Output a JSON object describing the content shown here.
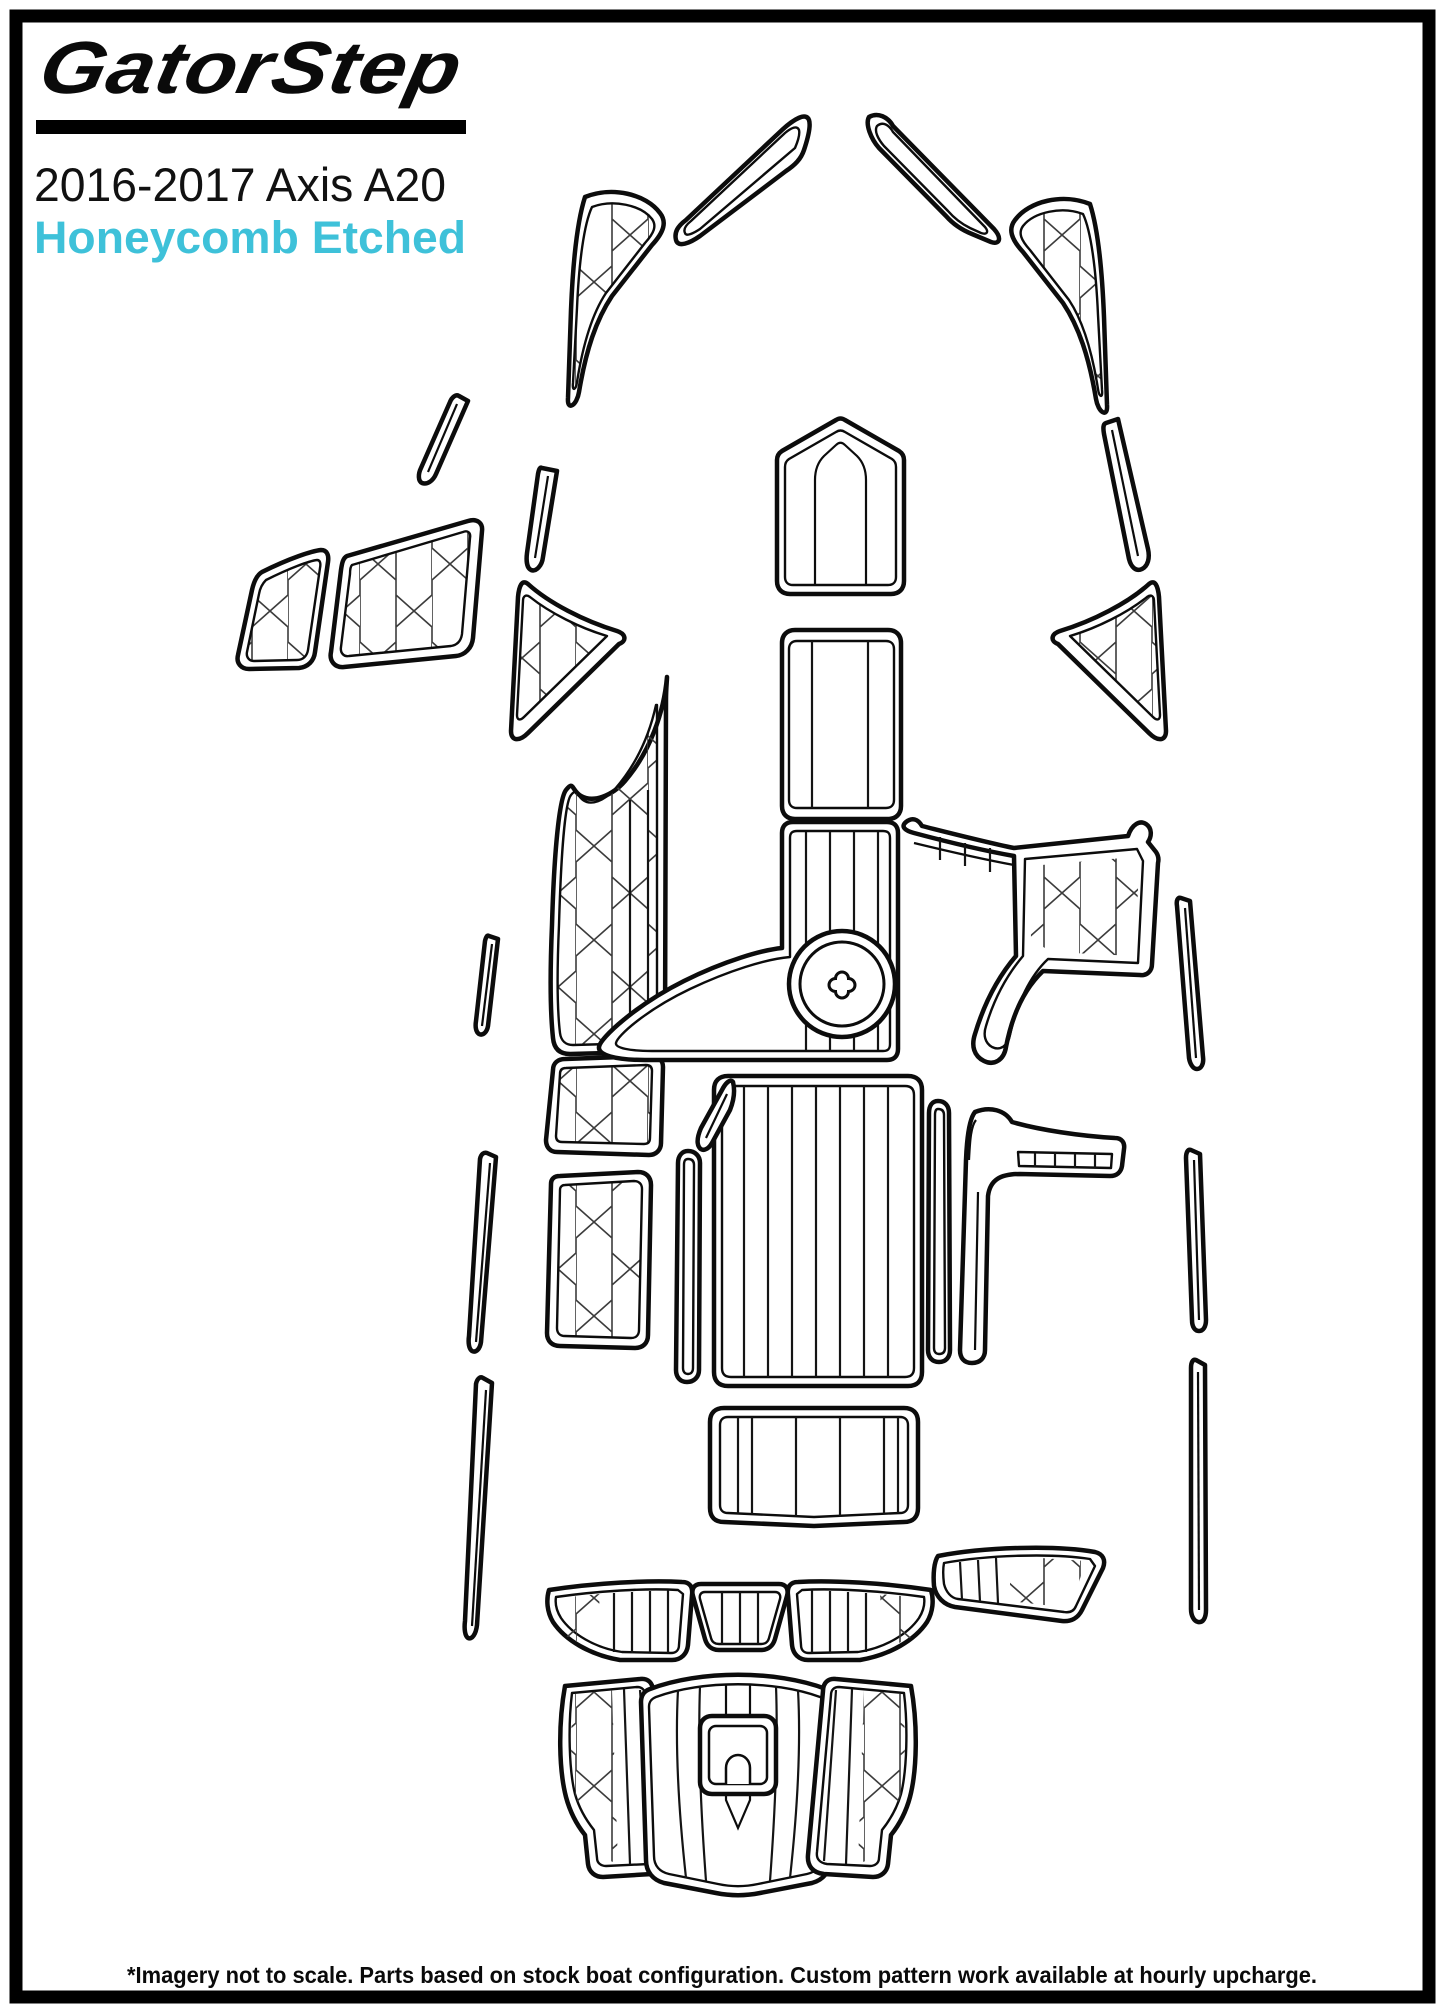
{
  "header": {
    "brand": "GatorStep",
    "title": "2016-2017 Axis A20",
    "subtitle": "Honeycomb Etched",
    "subtitle_color": "#3EC1D9",
    "brand_color": "#0a0a0a"
  },
  "footer": {
    "note": "*Imagery not to scale. Parts based on stock boat configuration. Custom pattern work available at hourly upcharge."
  },
  "page": {
    "background": "#ffffff",
    "border_color": "#000000",
    "line_color": "#0c0c0c"
  },
  "diagram": {
    "kind": "boat-deck-pad-template-top-view",
    "texture": "honeycomb-etched",
    "pieces": [
      "port-bow-pad",
      "port-bow-gunwale-strip",
      "starboard-bow-gunwale-strip",
      "starboard-bow-pad",
      "port-hull-strip-upper",
      "port-hull-strip-lower",
      "starboard-hull-strip",
      "port-storage-pad-small",
      "port-storage-pad-large",
      "port-step-triangle-pad",
      "starboard-step-triangle-pad",
      "port-bow-step-pad",
      "port-mid-pad-upper",
      "port-mid-pad-lower",
      "port-gunwale-strip-1",
      "port-gunwale-strip-2",
      "port-gunwale-strip-3",
      "starboard-gunwale-strip-1",
      "starboard-gunwale-strip-2",
      "starboard-gunwale-strip-3",
      "bow-walkway-shield-pad",
      "bow-walkway-pad",
      "ski-pylon-pad",
      "starboard-console-pad",
      "cockpit-floor-pad",
      "port-floor-sliver-pad",
      "port-floor-edge-pad",
      "starboard-floor-edge-pad",
      "starboard-console-step-pad",
      "rear-bench-pad",
      "stern-seat-pad-left",
      "stern-seat-pad-center",
      "stern-seat-pad-right",
      "starboard-gunwale-step-pad",
      "swim-platform-left-pad",
      "swim-platform-center-pad",
      "swim-platform-right-pad",
      "ladder-cutout"
    ]
  }
}
